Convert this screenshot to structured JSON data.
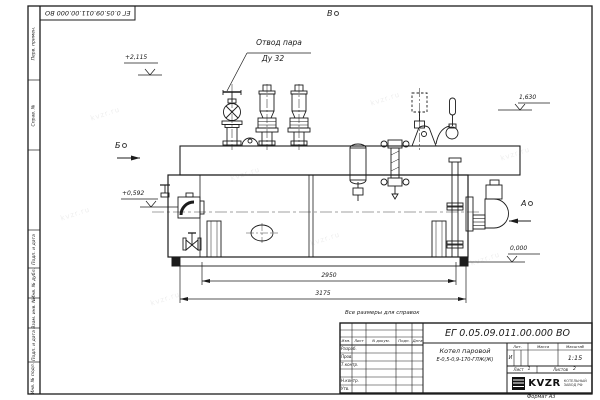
{
  "document": {
    "number": "ЕГ 0.05.09.011.00.000 ВО",
    "format_note": "Формат А3",
    "reference_note": "Все размеры для справок",
    "watermark": "kvzr.ru"
  },
  "margin_stamps": {
    "items": [
      "Перв. примен.",
      "Справ. №",
      "Подп. и дата",
      "Инв. № дубл.",
      "Взам. инв. №",
      "Подп. и дата",
      "Инв. № подл."
    ]
  },
  "views": {
    "a": "А",
    "b": "Б",
    "v": "В"
  },
  "elevations": {
    "top": "+2,115",
    "gauge": "1,630",
    "feed": "+0,592",
    "ground": "0,000"
  },
  "dimensions": {
    "length_inner": "2950",
    "length_total": "3175"
  },
  "callout": {
    "line1": "Отвод пара",
    "line2": "Ду 32"
  },
  "title_block": {
    "designation": "ЕГ 0.05.09.011.00.000  ВО",
    "product_name_1": "Котел паровой",
    "product_name_2": "Е-0,5-0,9-170-ГЛЖ(Ж)",
    "col_izm": "Изм.",
    "col_list": "Лист",
    "col_doc": "N докум.",
    "col_sign": "Подп.",
    "col_date": "Дата",
    "row_developed": "Разраб.",
    "row_checked": "Пров.",
    "row_tcontrol": "Т.контр.",
    "row_ncontrol": "Н.контр.",
    "row_approved": "Утв.",
    "lit_label": "Лит.",
    "mass_label": "Масса",
    "scale_label": "Масштаб",
    "lit_value": "И",
    "scale_value": "1:15",
    "sheet_label": "Лист",
    "sheet_value": "1",
    "sheets_label": "Листов",
    "sheets_value": "2",
    "company": "KVZR",
    "company_sub_1": "КОТЕЛЬНЫЙ",
    "company_sub_2": "ЗАВОД РФ"
  }
}
